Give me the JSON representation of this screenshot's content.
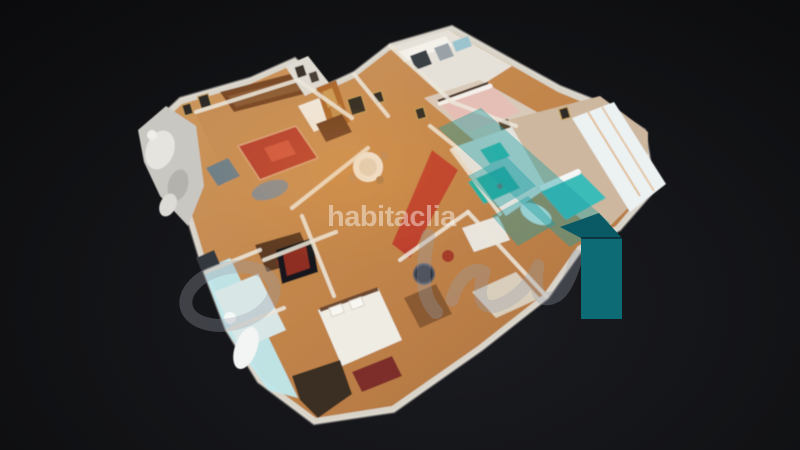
{
  "watermark": {
    "text": "habitaclia"
  },
  "brand": {
    "teal_solid": "#0d6b76",
    "teal_roof": "#0a5a66",
    "teal_overlay": "rgba(32,158,163,0.42)",
    "script_gray": "rgba(152,158,170,0.32)",
    "house_edge_line": "#0e2532"
  },
  "background": {
    "edge": "#0b0b0d",
    "center": "#1b1c21"
  },
  "palette": {
    "wood_floor": "#c68e55",
    "wall_white": "#ece6da",
    "rug_red": "#b5402f",
    "hall_red": "#bc3a2b",
    "bathroom_teal": "#25b0a2",
    "bed_teal": "#3abcb8",
    "cut_wall_cyan": "#bfe7ec",
    "curtain_white": "#ecf1f2",
    "dark_furniture": "#7a4a28"
  }
}
